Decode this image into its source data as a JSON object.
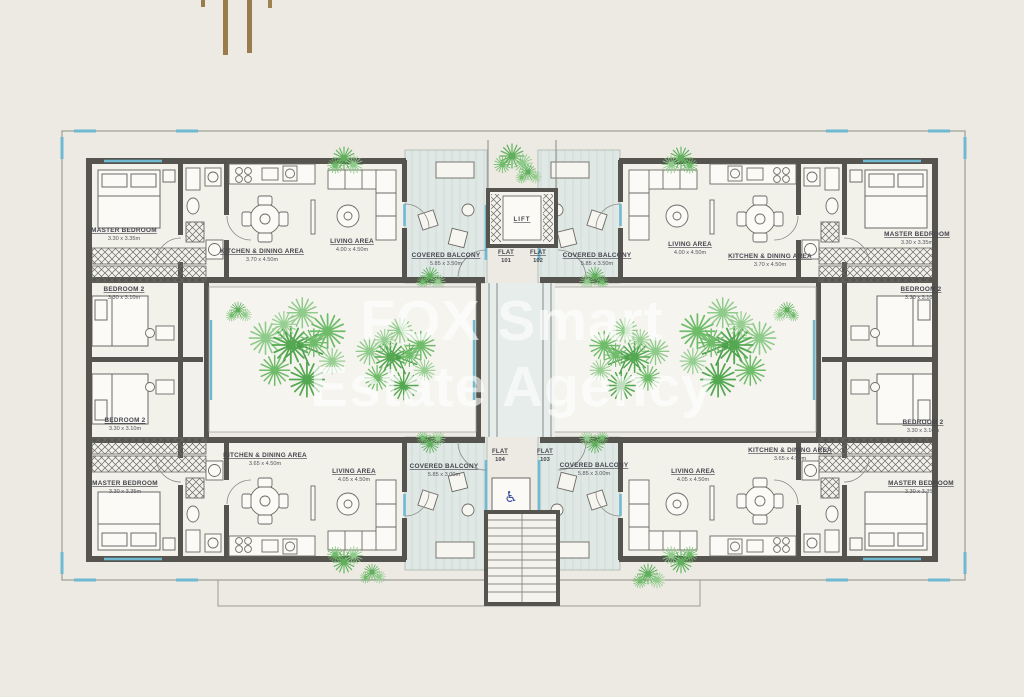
{
  "watermark": {
    "line1": "FOX Smart",
    "line2": "Estate Agency"
  },
  "logo": {
    "description": "gold-vertical-bars-logo",
    "color": "#9A7B4B"
  },
  "floor_plan": {
    "lift_label": "LIFT",
    "flat_word": "FLAT",
    "flat_numbers": {
      "f101": "101",
      "f102": "102",
      "f103": "103",
      "f104": "104"
    },
    "rooms": {
      "master_bedroom": {
        "name": "MASTER BEDROOM",
        "dim": "3.30 x 3.35m"
      },
      "bedroom_2": {
        "name": "BEDROOM 2",
        "dim": "3.30 x 3.10m"
      },
      "kitchen_dining_upper": {
        "name": "KITCHEN & DINING AREA",
        "dim": "3.70 x 4.50m"
      },
      "kitchen_dining_lower": {
        "name": "KITCHEN & DINING AREA",
        "dim": "3.65 x 4.50m"
      },
      "living_upper": {
        "name": "LIVING AREA",
        "dim": "4.00 x 4.50m"
      },
      "living_lower": {
        "name": "LIVING AREA",
        "dim": "4.05 x 4.50m"
      },
      "covered_balcony_upper": {
        "name": "COVERED BALCONY",
        "dim": "5.85 x 3.50m"
      },
      "covered_balcony_lower": {
        "name": "COVERED BALCONY",
        "dim": "5.85 x 3.00m"
      }
    },
    "icons": {
      "accessibility": "♿"
    },
    "colors": {
      "background": "#ECEAE2",
      "floor": "#F2F1EA",
      "wall": "#55544E",
      "window_accent": "#6FB9D2",
      "balcony_tint": "#DFE8E4",
      "tree_green": "#61B35E",
      "label_text": "#45454E",
      "accessibility_blue": "#3B4F9E",
      "watermark_white": "rgba(255,255,255,0.62)",
      "logo_gold": "#9A7B4B"
    }
  }
}
